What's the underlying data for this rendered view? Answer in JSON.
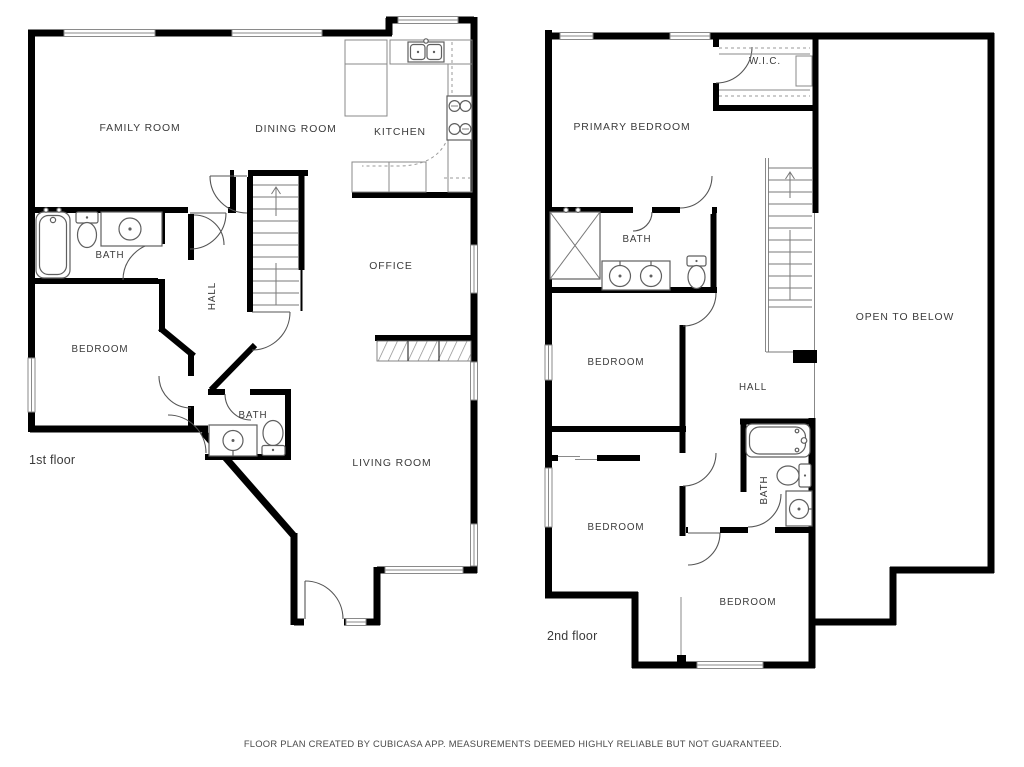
{
  "colors": {
    "wall": "#000000",
    "fixture_line": "#5f5f5f",
    "label_text": "#3b3b3b",
    "background": "#ffffff"
  },
  "floor1": {
    "label": "1st floor",
    "rooms": {
      "family_room": "FAMILY ROOM",
      "dining_room": "DINING ROOM",
      "kitchen": "KITCHEN",
      "bath": "BATH",
      "hall": "HALL",
      "bedroom": "BEDROOM",
      "office": "OFFICE",
      "bath_small": "BATH",
      "living_room": "LIVING ROOM"
    }
  },
  "floor2": {
    "label": "2nd floor",
    "rooms": {
      "wic": "W.I.C.",
      "primary_bedroom": "PRIMARY BEDROOM",
      "bath": "BATH",
      "bedroom_mid": "BEDROOM",
      "hall": "HALL",
      "open_to_below": "OPEN TO BELOW",
      "bath_right": "BATH",
      "bedroom_lower_left": "BEDROOM",
      "bedroom_lower_right": "BEDROOM"
    }
  },
  "footer": {
    "disclaimer": "FLOOR PLAN CREATED BY CUBICASA APP. MEASUREMENTS DEEMED HIGHLY RELIABLE BUT NOT GUARANTEED."
  }
}
